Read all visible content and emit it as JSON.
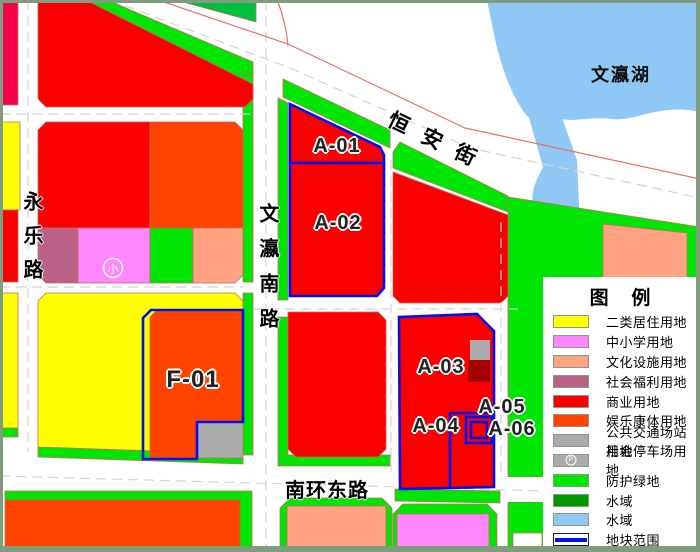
{
  "map": {
    "roads": {
      "hengan_street": "恒安街",
      "wenying_south_road": "文瀛南路",
      "yongle_road": "永乐路",
      "nanhuan_east_road": "南环东路"
    },
    "lake_label": "文瀛湖",
    "blocks": {
      "a01": "A-01",
      "a02": "A-02",
      "a03": "A-03",
      "a04": "A-04",
      "a05": "A-05",
      "a06": "A-06",
      "f01": "F-01"
    },
    "school_symbol": "小"
  },
  "legend": {
    "title": "图  例",
    "parking_symbol": "P",
    "items": [
      {
        "label": "二类居住用地",
        "color": "#FFFF00",
        "type": "fill"
      },
      {
        "label": "中小学用地",
        "color": "#FF86FF",
        "type": "fill"
      },
      {
        "label": "文化设施用地",
        "color": "#FFA382",
        "type": "fill"
      },
      {
        "label": "社会福利用地",
        "color": "#BC6288",
        "type": "fill"
      },
      {
        "label": "商业用地",
        "color": "#FA0000",
        "type": "fill"
      },
      {
        "label": "娱乐康体用地",
        "color": "#FF4300",
        "type": "fill"
      },
      {
        "label": "公共交通场站用地",
        "color": "#ABABAB",
        "type": "fill"
      },
      {
        "label": "社会停车场用地",
        "color": "#ABABAB",
        "type": "parking"
      },
      {
        "label": "防护绿地",
        "color": "#00E604",
        "type": "fill"
      },
      {
        "label": "水域",
        "color": "#009800",
        "type": "fill"
      },
      {
        "label": "水域",
        "color": "#8FC7F5",
        "type": "fill"
      },
      {
        "label": "地块范围",
        "color": "#0010F0",
        "type": "boundary"
      }
    ]
  }
}
